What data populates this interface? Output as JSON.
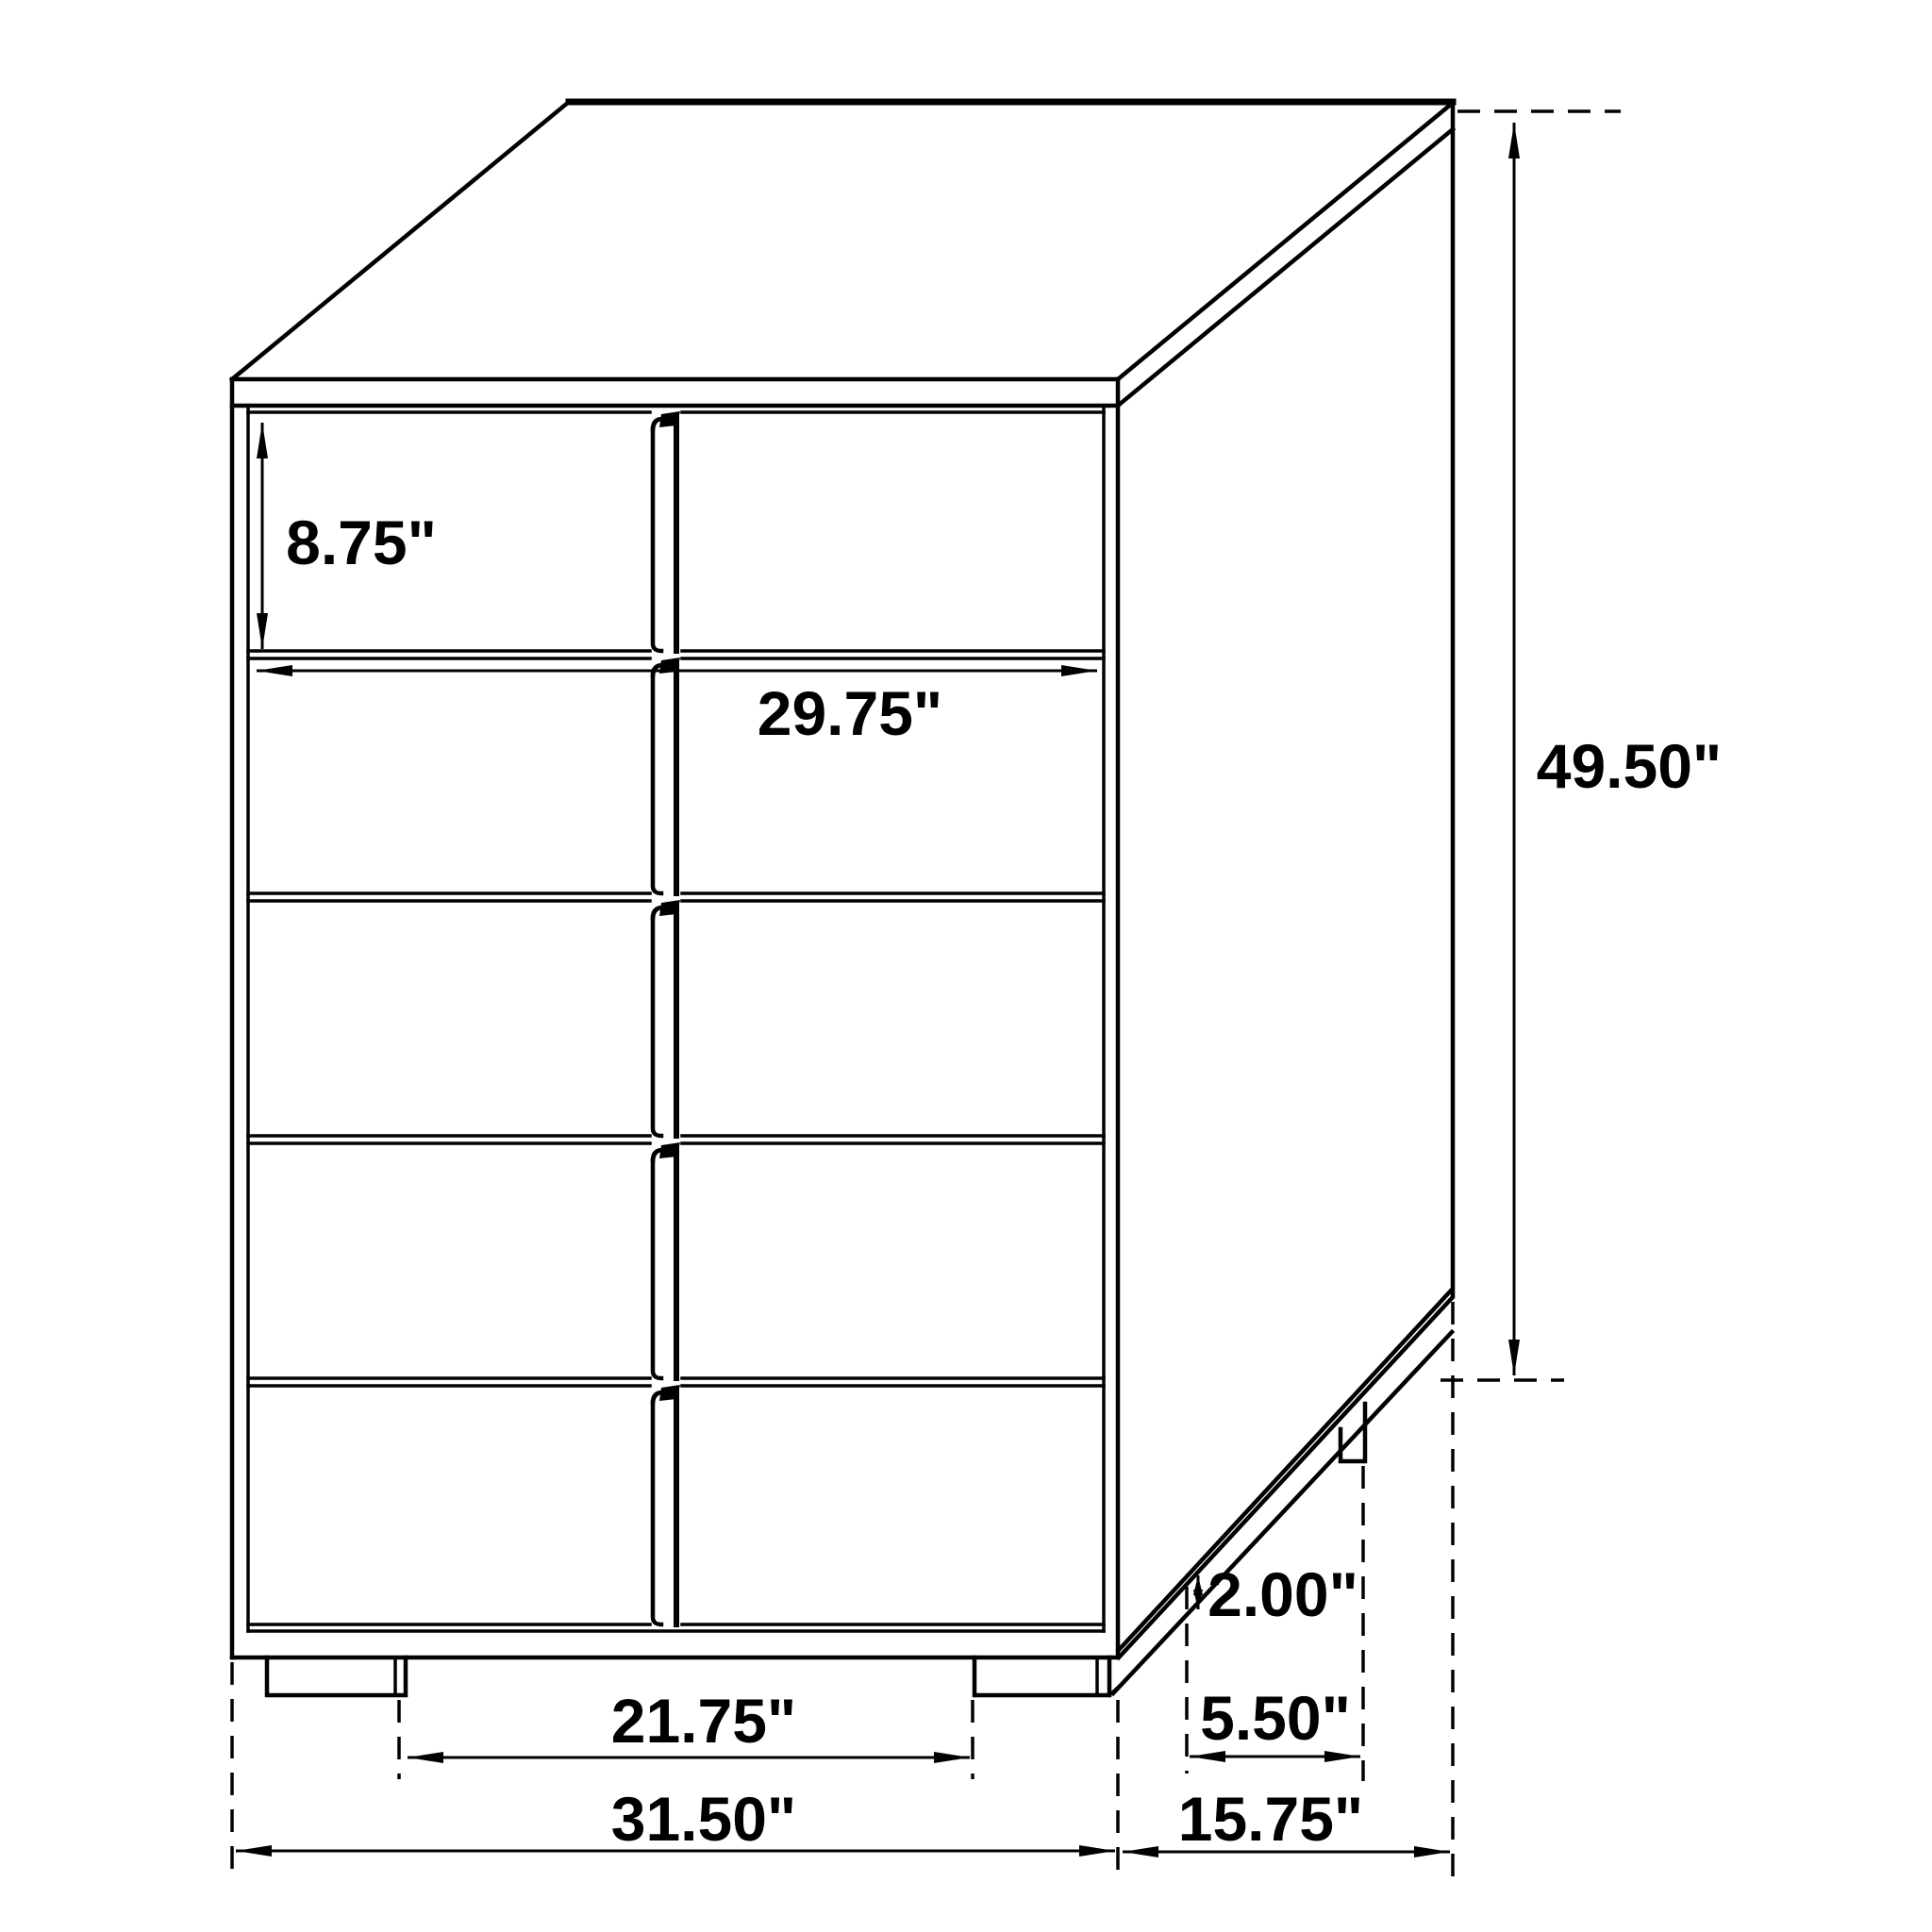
{
  "diagram": {
    "type": "furniture-dimension-diagram",
    "subject": "five-drawer chest perspective line drawing with dimension callouts",
    "background_color": "#ffffff",
    "line_color": "#000000",
    "units": "inches",
    "labels": {
      "drawer_front_height": "8.75\"",
      "drawer_width": "29.75\"",
      "overall_height": "49.50\"",
      "leg_height": "2.00\"",
      "side_leg_inset": "5.50\"",
      "front_leg_spacing": "21.75\"",
      "overall_width": "31.50\"",
      "overall_depth": "15.75\""
    }
  }
}
